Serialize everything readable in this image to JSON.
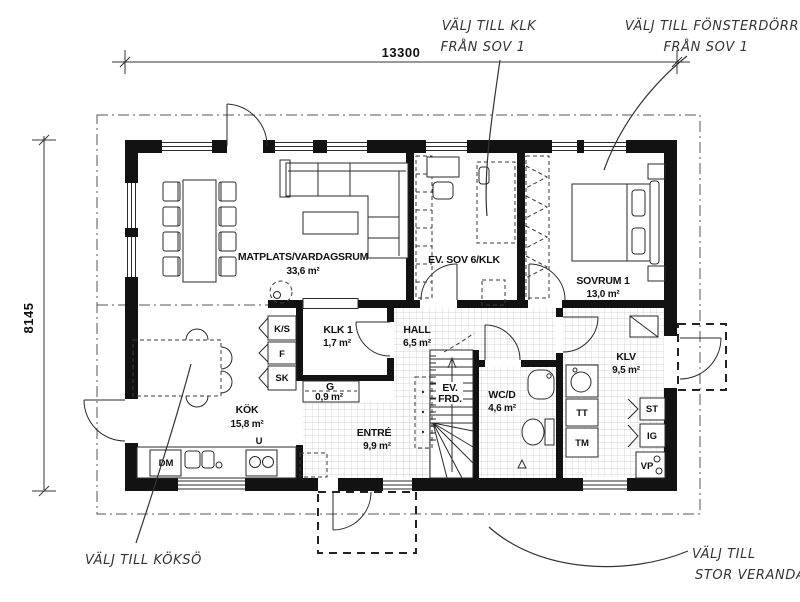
{
  "dimensions": {
    "width_label": "13300",
    "height_label": "8145"
  },
  "annotations": {
    "klk": {
      "line1": "VÄLJ TILL KLK",
      "line2": "FRÅN SOV 1"
    },
    "fonsterdorr": {
      "line1": "VÄLJ TILL FÖNSTERDÖRR",
      "line2": "FRÅN SOV 1"
    },
    "kokso": {
      "line1": "VÄLJ TILL KÖKSÖ"
    },
    "veranda": {
      "line1": "VÄLJ TILL",
      "line2": "STOR VERANDA"
    }
  },
  "rooms": {
    "matplats": {
      "name": "MATPLATS/VARDAGSRUM",
      "area": "33,6 m²"
    },
    "ev_sov6": {
      "name": "EV. SOV 6/KLK"
    },
    "sovrum1": {
      "name": "SOVRUM 1",
      "area": "13,0 m²"
    },
    "klk1": {
      "name": "KLK 1",
      "area": "1,7 m²"
    },
    "hall": {
      "name": "HALL",
      "area": "6,5 m²"
    },
    "g": {
      "name": "G",
      "area": "0,9 m²"
    },
    "kok": {
      "name": "KÖK",
      "area": "15,8 m²"
    },
    "entre": {
      "name": "ENTRÉ",
      "area": "9,9 m²"
    },
    "ev_frd": {
      "line1": "EV.",
      "line2": "FRD."
    },
    "wcd": {
      "name": "WC/D",
      "area": "4,6 m²"
    },
    "klv": {
      "name": "KLV",
      "area": "9,5 m²"
    }
  },
  "fixtures": {
    "ks": "K/S",
    "f": "F",
    "sk": "SK",
    "dm": "DM",
    "u": "U",
    "tt": "TT",
    "tm": "TM",
    "st": "ST",
    "ig": "IG",
    "vp": "VP"
  },
  "colors": {
    "wall": "#121212",
    "line": "#2a2a2a",
    "tile": "#c9c9c9",
    "annotation": "#333333"
  }
}
